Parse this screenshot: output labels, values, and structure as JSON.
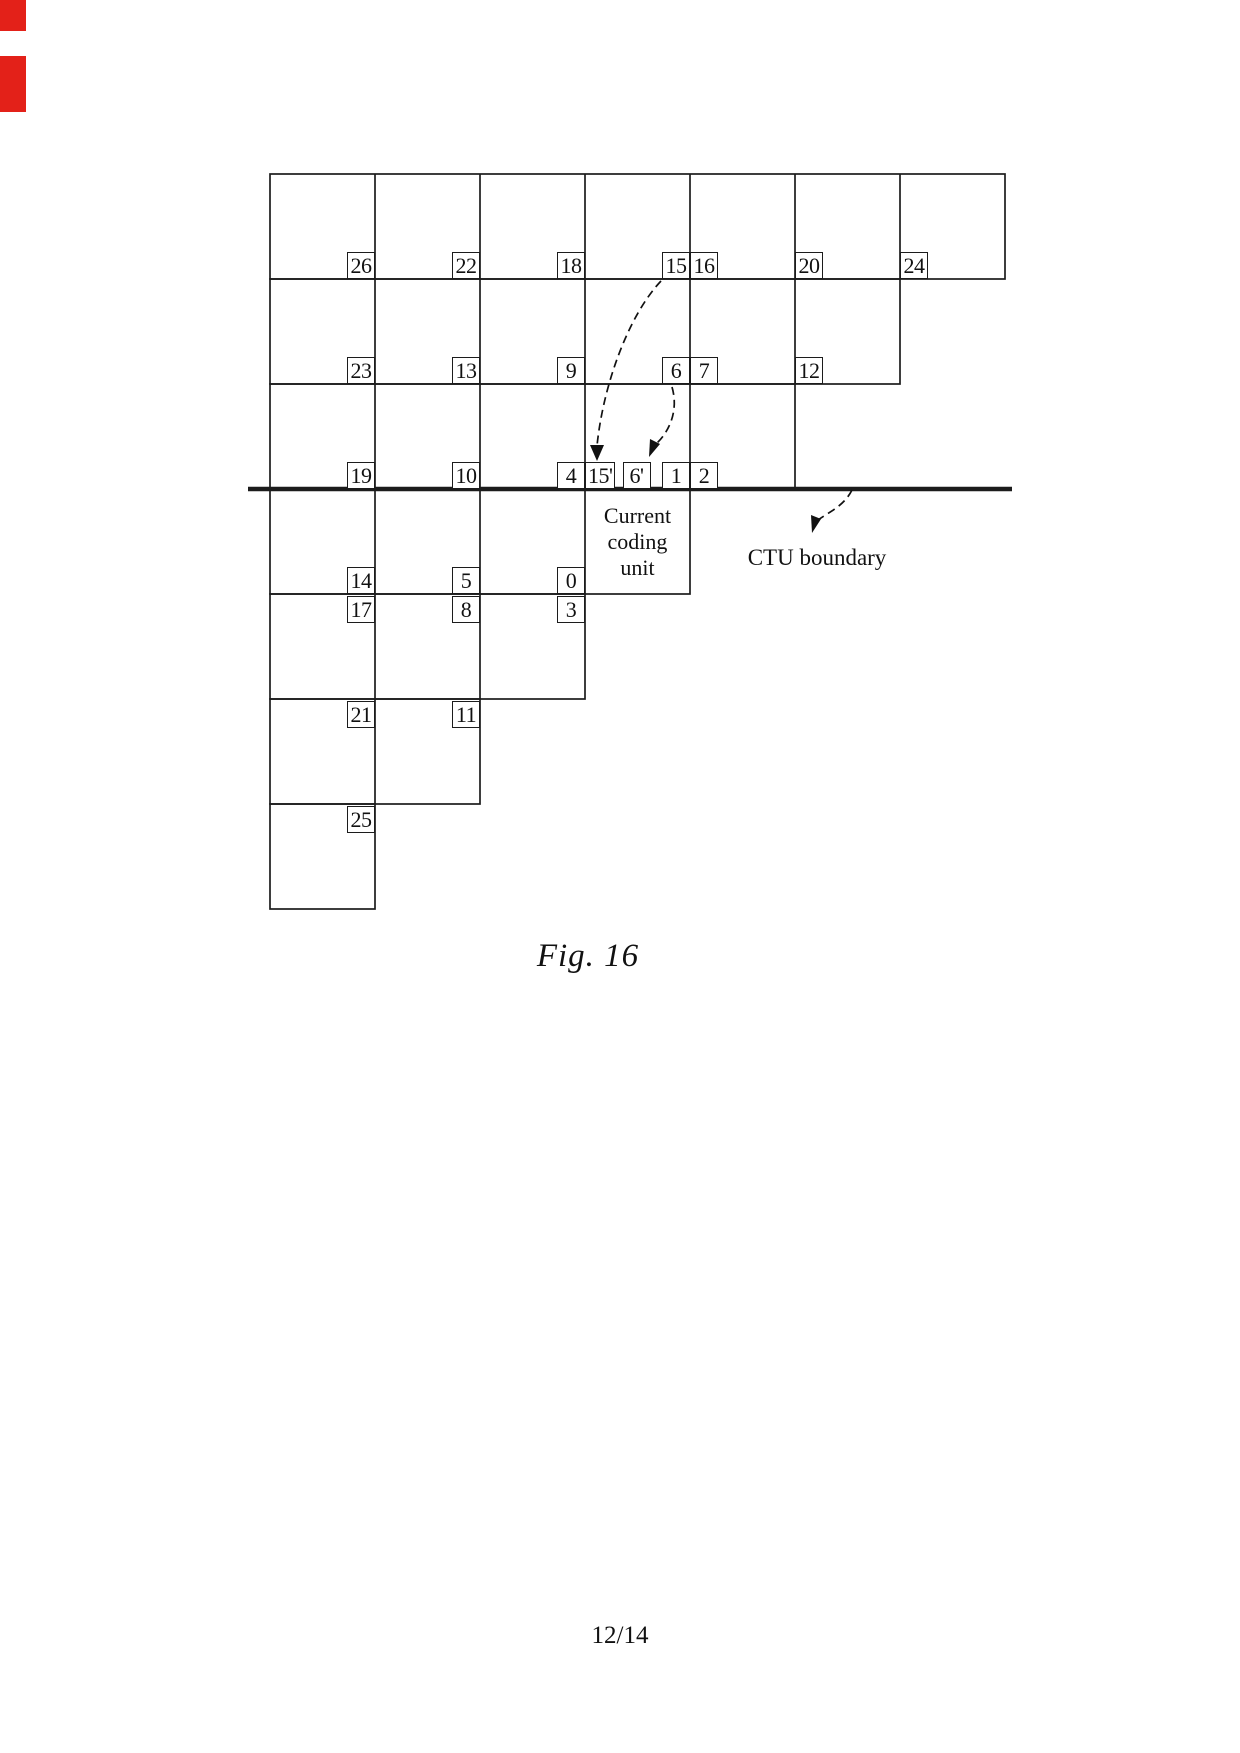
{
  "page": {
    "caption": "Fig. 16",
    "page_number": "12/14",
    "background": "#ffffff"
  },
  "colors": {
    "line": "#1c1c1c",
    "arrow": "#111111",
    "label_text": "#111111",
    "red_edge_mark": "#e32119"
  },
  "diagram": {
    "staircase_rows_cells": [
      7,
      6,
      5,
      4,
      3,
      2,
      1
    ],
    "unit_labels": [
      {
        "text": "26",
        "row": 1,
        "col": 1,
        "corner": "br"
      },
      {
        "text": "22",
        "row": 1,
        "col": 2,
        "corner": "br"
      },
      {
        "text": "18",
        "row": 1,
        "col": 3,
        "corner": "br"
      },
      {
        "text": "15",
        "row": 1,
        "col": 4,
        "corner": "br"
      },
      {
        "text": "16",
        "row": 1,
        "col": 5,
        "corner": "bl"
      },
      {
        "text": "20",
        "row": 1,
        "col": 6,
        "corner": "bl"
      },
      {
        "text": "24",
        "row": 1,
        "col": 7,
        "corner": "bl"
      },
      {
        "text": "23",
        "row": 2,
        "col": 1,
        "corner": "br"
      },
      {
        "text": "13",
        "row": 2,
        "col": 2,
        "corner": "br"
      },
      {
        "text": "9",
        "row": 2,
        "col": 3,
        "corner": "br"
      },
      {
        "text": "6",
        "row": 2,
        "col": 4,
        "corner": "br"
      },
      {
        "text": "7",
        "row": 2,
        "col": 5,
        "corner": "bl"
      },
      {
        "text": "12",
        "row": 2,
        "col": 6,
        "corner": "bl"
      },
      {
        "text": "19",
        "row": 3,
        "col": 1,
        "corner": "br"
      },
      {
        "text": "10",
        "row": 3,
        "col": 2,
        "corner": "br"
      },
      {
        "text": "4",
        "row": 3,
        "col": 3,
        "corner": "br"
      },
      {
        "text": "15'",
        "row": 3,
        "col": 4,
        "corner": "bl"
      },
      {
        "text": "6'",
        "row": 3,
        "col": 4,
        "corner": "bm"
      },
      {
        "text": "1",
        "row": 3,
        "col": 4,
        "corner": "br"
      },
      {
        "text": "2",
        "row": 3,
        "col": 5,
        "corner": "bl"
      },
      {
        "text": "14",
        "row": 4,
        "col": 1,
        "corner": "br"
      },
      {
        "text": "5",
        "row": 4,
        "col": 2,
        "corner": "br"
      },
      {
        "text": "0",
        "row": 4,
        "col": 3,
        "corner": "br"
      },
      {
        "text": "17",
        "row": 5,
        "col": 1,
        "corner": "tr"
      },
      {
        "text": "8",
        "row": 5,
        "col": 2,
        "corner": "tr"
      },
      {
        "text": "3",
        "row": 5,
        "col": 3,
        "corner": "tr"
      },
      {
        "text": "21",
        "row": 6,
        "col": 1,
        "corner": "tr"
      },
      {
        "text": "11",
        "row": 6,
        "col": 2,
        "corner": "tr"
      },
      {
        "text": "25",
        "row": 7,
        "col": 1,
        "corner": "tr"
      }
    ],
    "current_unit": {
      "lines": [
        "Current",
        "coding",
        "unit"
      ],
      "row": 4,
      "col": 4
    },
    "ctu_boundary_label": "CTU boundary",
    "arrows": [
      {
        "from": "15",
        "to": "15'"
      },
      {
        "from": "6",
        "to": "6'"
      },
      {
        "from": "ctu-boundary-line",
        "to": "CTU boundary label"
      }
    ]
  }
}
